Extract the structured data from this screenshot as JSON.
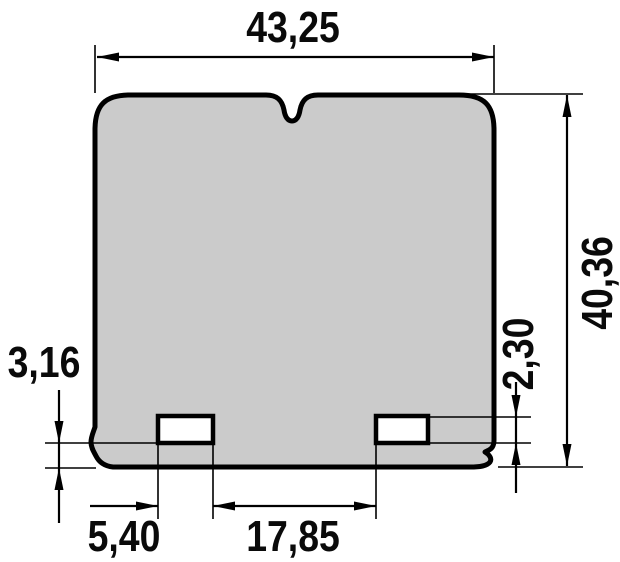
{
  "drawing": {
    "labels": {
      "overall_width": "43,25",
      "overall_height": "40,36",
      "slot_height": "2,30",
      "bottom_offset": "3,16",
      "slot_left_offset": "5,40",
      "slot_spacing": "17,85"
    },
    "colors": {
      "part_fill": "#cbcbcb",
      "hole_fill": "#ffffff",
      "line": "#000000",
      "background": "#ffffff"
    }
  }
}
